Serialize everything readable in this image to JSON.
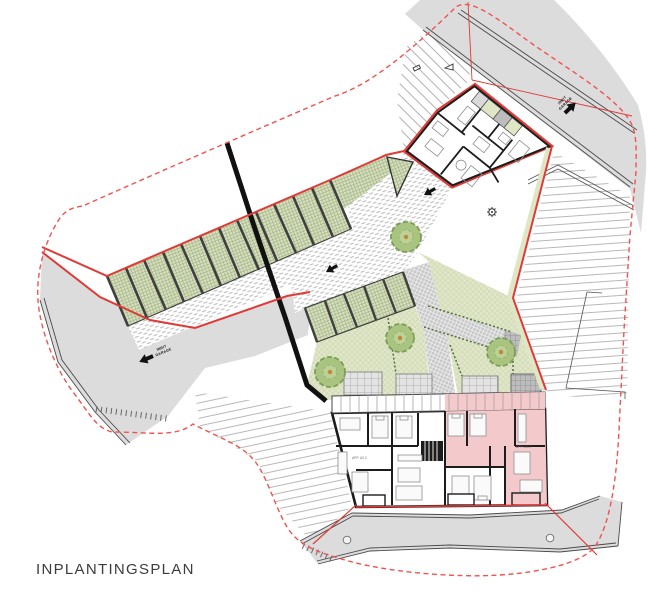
{
  "title": "INPLANTINGSPLAN",
  "labels": {
    "garage_entry_line1": "INRIT",
    "garage_entry_line2": "GARAGE",
    "apartment_left": "APP. A2.2",
    "apartment_right": "APP. A1.2"
  },
  "colors": {
    "boundary_red_solid": "#e03a36",
    "boundary_red_dashed": "#ef5350",
    "street_gray": "#dcdcdc",
    "garden_green": "#e0e6ca",
    "parking_stall_green": "#d7dfc2",
    "highlight_pink": "#f3c9cb",
    "wall_black": "#1c1c1c",
    "tree_green": "#a9c481"
  },
  "site": {
    "parking_row_a_stalls": 12,
    "parking_row_b_stalls": 5,
    "trees": 4,
    "manholes": 2,
    "garden_terraces": 4
  }
}
